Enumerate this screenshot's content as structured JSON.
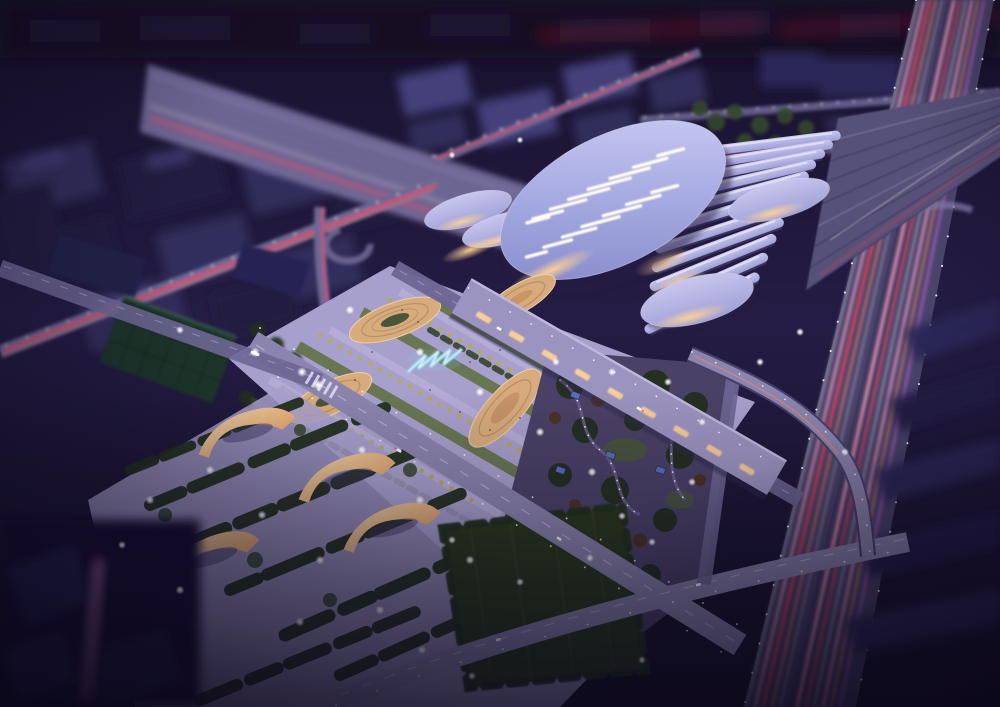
{
  "meta": {
    "scene_type": "architectural-night-aerial-rendering",
    "subject": "railway-station-complex-with-elliptical-roof",
    "time_of_day": "night",
    "counts": {
      "platform_canopies": 11,
      "roof_skylight_slits": 15,
      "small_oval_canopies": 5,
      "plaza_terrace_eyes": 4,
      "park_berms": 4
    }
  },
  "palette": {
    "bg_top": "#17112c",
    "bg_mid": "#241c44",
    "bg_bottom": "#151026",
    "city_dark": "#221c40",
    "city_mid": "#332d5c",
    "city_light": "#45407a",
    "silhouette": "#1c1736",
    "corridor": "#6f6795",
    "corridor_line": "#545078",
    "deck": "#575178",
    "track_dark": "#3f3a66",
    "track_light": "#8d86b5",
    "canopy_hi": "#e9e7f8",
    "canopy_light": "#c9c7ee",
    "canopy_mid": "#9fa0d6",
    "canopy_shadow": "#46406e",
    "roof_light": "#d0cff4",
    "roof_mid": "#a6aae2",
    "roof_dark": "#7f84c4",
    "roof_rim": "#e0def8",
    "skylight": "#fffdf0",
    "warm_glow": "#ffd296",
    "warm_deep": "#e0a066",
    "facade": "#9c94c0",
    "plaza": "#a8a0cc",
    "plaza_band": "#b6aed9",
    "terrace_warm": "#d8ab7c",
    "terrace_light": "#eed0a6",
    "terrace_ring": "#b3885a",
    "road": "#8b84ae",
    "road_dark": "#6e6794",
    "lawn": "#67744d",
    "lawn_dark": "#49563b",
    "tree_dark": "#232f1e",
    "tree_green": "#36452c",
    "tree_autumn": "#4c3120",
    "tree_yellow": "#b4aa5e",
    "water": "#8fd0ea",
    "water_core": "#eafcff",
    "park_ground": "#4a4166",
    "park_path": "#6b6090",
    "pavilion": "#5a6cc0",
    "field": "#2a381f",
    "green_roof": "#1e342b",
    "highway": "#4e4870",
    "highway_median": "#403a60",
    "ramp": "#8b84ae",
    "block_right": "#2b2656",
    "streak_red": "#ff4455",
    "streak_orange": "#ff8866",
    "streak_pink": "#ff9fc0",
    "streak_magenta": "#c86ad4",
    "streak_white": "#fff3f6",
    "lamp": "#ffffff",
    "lamp_warm": "#ffd9a8",
    "shadow_dark": "#251f44",
    "vignette": "#0b071a"
  }
}
